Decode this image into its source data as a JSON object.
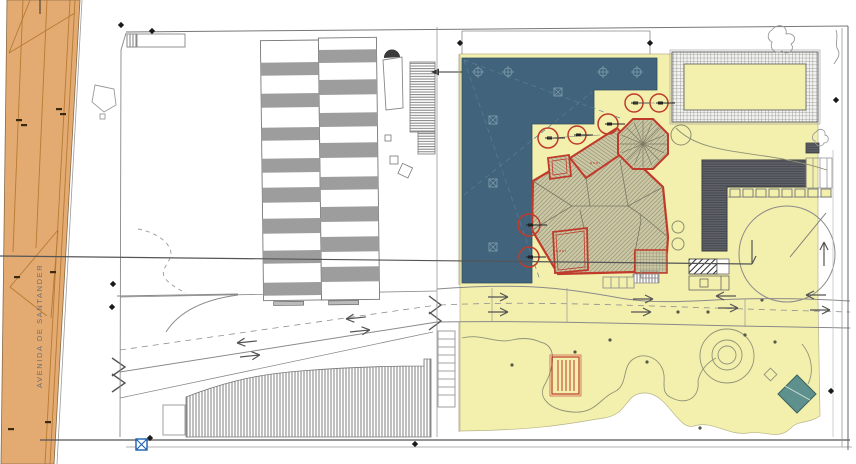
{
  "plan": {
    "street_label": "AVENIDA DE SANTANDER",
    "zones": [
      {
        "name": "avenue-road",
        "color": "#e3aa72"
      },
      {
        "name": "paved-plaza",
        "color": "#41637b"
      },
      {
        "name": "garden-area",
        "color": "#f3efad"
      },
      {
        "name": "main-building-roof",
        "color": "#cbc7a3"
      },
      {
        "name": "service-building-roof",
        "color": "#60646a"
      },
      {
        "name": "teal-platform",
        "color": "#5e918d"
      }
    ]
  },
  "colors": {
    "avenue_fill": "#e3aa72",
    "avenue_line": "#b77b33",
    "plaza_fill": "#41637b",
    "plaza_symbol": "#7e9aab",
    "garden_fill": "#f3efad",
    "roof_fill": "#cbc7a3",
    "roof_line": "#84846d",
    "building_red": "#c03a2b",
    "dark_roof": "#60646a",
    "stripe_gray": "#9d9d9d",
    "line_gray": "#8a8a8a",
    "path_green": "#8f9377",
    "teal_fill": "#5e918d",
    "teal_edge": "#3c6360",
    "stamp_red": "#c0392b",
    "blue_mark": "#1b5fae",
    "ink": "#1a1a1a"
  },
  "icons": {
    "tree": "red-circle-with-branch-tick",
    "shrub": "gray-circle",
    "sprinkler": "small-circle-with-ticks",
    "control_point": "x-in-square",
    "survey_point": "black-diamond",
    "drain": "blue-x-box",
    "traffic_arrow": "open-arrow"
  },
  "symbols": {
    "tower": {
      "cx": 643,
      "cy": 144,
      "r": 23
    },
    "trees_red": [
      {
        "x": 548,
        "y": 138,
        "r": 10
      },
      {
        "x": 577,
        "y": 135,
        "r": 9
      },
      {
        "x": 608,
        "y": 124,
        "r": 10
      },
      {
        "x": 634,
        "y": 103,
        "r": 9
      },
      {
        "x": 659,
        "y": 103,
        "r": 9
      },
      {
        "x": 529,
        "y": 225,
        "r": 11
      },
      {
        "x": 529,
        "y": 257,
        "r": 10
      }
    ],
    "trees_gray": [
      {
        "x": 681,
        "y": 135,
        "r": 10
      },
      {
        "x": 678,
        "y": 227,
        "r": 6
      },
      {
        "x": 678,
        "y": 244,
        "r": 6
      }
    ],
    "sprinklers": [
      {
        "x": 478,
        "y": 72
      },
      {
        "x": 508,
        "y": 72
      },
      {
        "x": 603,
        "y": 72
      },
      {
        "x": 637,
        "y": 72
      }
    ],
    "control_points": [
      {
        "x": 558,
        "y": 92
      },
      {
        "x": 493,
        "y": 120
      },
      {
        "x": 493,
        "y": 183
      },
      {
        "x": 493,
        "y": 247
      }
    ],
    "road_arrows": [
      {
        "x": 488,
        "y": 297,
        "dir": "right",
        "rot": 0
      },
      {
        "x": 488,
        "y": 312,
        "dir": "right",
        "rot": 0
      },
      {
        "x": 633,
        "y": 299,
        "dir": "right",
        "rot": 0
      },
      {
        "x": 631,
        "y": 312,
        "dir": "right",
        "rot": 0
      },
      {
        "x": 716,
        "y": 296,
        "dir": "left",
        "rot": 0
      },
      {
        "x": 718,
        "y": 308,
        "dir": "right",
        "rot": 0
      },
      {
        "x": 806,
        "y": 295,
        "dir": "left",
        "rot": 0
      },
      {
        "x": 810,
        "y": 310,
        "dir": "right",
        "rot": 0
      },
      {
        "x": 237,
        "y": 343,
        "dir": "left",
        "rot": -6
      },
      {
        "x": 240,
        "y": 357,
        "dir": "right",
        "rot": -6
      },
      {
        "x": 346,
        "y": 319,
        "dir": "left",
        "rot": -6
      },
      {
        "x": 350,
        "y": 332,
        "dir": "right",
        "rot": -6
      },
      {
        "x": 752,
        "y": 240,
        "dir": "down",
        "rot": 0
      },
      {
        "x": 824,
        "y": 266,
        "dir": "up",
        "rot": 0
      }
    ],
    "survey_points": [
      {
        "x": 121,
        "y": 25
      },
      {
        "x": 152,
        "y": 31
      },
      {
        "x": 113,
        "y": 284
      },
      {
        "x": 112,
        "y": 307
      },
      {
        "x": 415,
        "y": 444
      },
      {
        "x": 836,
        "y": 100
      },
      {
        "x": 831,
        "y": 391
      },
      {
        "x": 150,
        "y": 438
      },
      {
        "x": 460,
        "y": 43
      },
      {
        "x": 650,
        "y": 43
      }
    ],
    "garden_dots": [
      {
        "x": 512,
        "y": 365
      },
      {
        "x": 575,
        "y": 352
      },
      {
        "x": 610,
        "y": 340
      },
      {
        "x": 647,
        "y": 362
      },
      {
        "x": 678,
        "y": 312
      },
      {
        "x": 708,
        "y": 312
      },
      {
        "x": 745,
        "y": 335
      },
      {
        "x": 775,
        "y": 342
      },
      {
        "x": 762,
        "y": 300
      },
      {
        "x": 700,
        "y": 428
      }
    ],
    "avenue_ticks": [
      {
        "x": 16,
        "y": 119
      },
      {
        "x": 21,
        "y": 124
      },
      {
        "x": 56,
        "y": 108
      },
      {
        "x": 60,
        "y": 113
      },
      {
        "x": 14,
        "y": 276
      },
      {
        "x": 50,
        "y": 271
      },
      {
        "x": 8,
        "y": 428
      },
      {
        "x": 45,
        "y": 421
      }
    ]
  }
}
